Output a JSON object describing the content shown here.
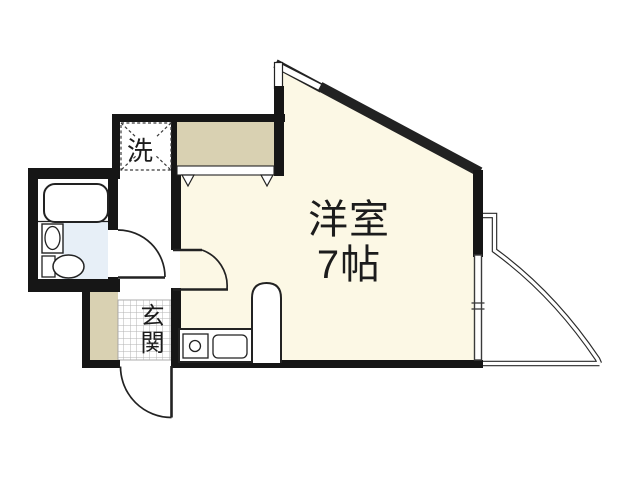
{
  "floorplan": {
    "title": "apartment-floor-plan",
    "room": {
      "name": "洋室",
      "size": "7帖"
    },
    "washer_label": "洗",
    "entrance_label": "玄関",
    "areas": {
      "main_room": "洋室 7帖",
      "entrance": "玄関",
      "washer_space": "洗",
      "closet": "closet",
      "bathroom": "unit-bath",
      "kitchen": "kitchenette",
      "balcony": "balcony"
    },
    "colors": {
      "wall": "#161616",
      "line": "#222222",
      "room-floor": "#fcf8e5",
      "closet-fill": "#d9d1b2",
      "bath-floor": "#e7eff7",
      "hatch": "#b3b3b3",
      "text": "#1c1c1c"
    }
  }
}
